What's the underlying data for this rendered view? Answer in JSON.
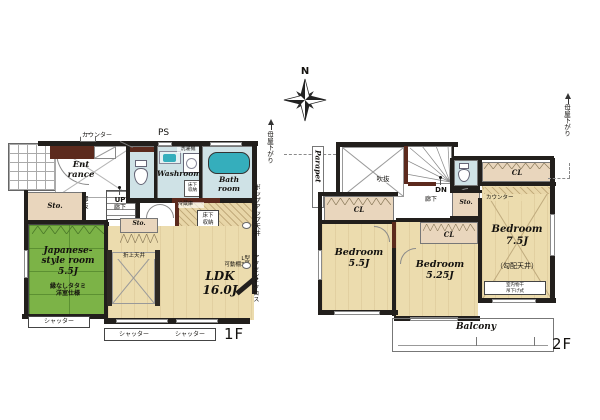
{
  "compass": {
    "north_label": "N"
  },
  "colors": {
    "wall": "#221f1c",
    "accent_wall": "#5c2a1d",
    "tatami_green": "#7cb347",
    "wood_floor": "#ecdcae",
    "wet_area": "#cfe2e6",
    "fixture_teal": "#35aebc",
    "sink_blue": "#2878b0",
    "storage_beige": "#e9d6bd"
  },
  "floor1": {
    "label": "1F",
    "rooms": {
      "entrance": "Ent\nrance",
      "storage1": "Sto.",
      "storage2": "Sto.",
      "japanese_room": "Japanese-\nstyle room\n5.5J",
      "japanese_room_note": "縁なしタタミ\n洋室仕様",
      "ldk": "LDK\n16.0J",
      "washroom": "Washroom",
      "bathroom": "Bath\nroom"
    },
    "labels": {
      "counter": "カウンター",
      "ps": "PS",
      "washing_machine": "洗濯機",
      "underfloor_storage": "床下\n収納",
      "upper_void": "上部\n吹抜",
      "up": "UP",
      "hallway": "廊下",
      "refrigerator": "冷蔵庫",
      "coffered_ceiling": "折上天井",
      "popup_ceiling": "ポップアップ天井",
      "l_shelf": "L型\n可動棚3段",
      "accent_cloth": "アクセントクロス",
      "shutter": "シャッター"
    }
  },
  "floor2": {
    "label": "2F",
    "rooms": {
      "bedroom1": "Bedroom\n5.5J",
      "bedroom2": "Bedroom\n5.25J",
      "bedroom3": "Bedroom\n7.5J",
      "bedroom3_note": "（勾配天井）",
      "balcony": "Balcony",
      "parapet": "Parapet",
      "closet": "CL",
      "storage": "Sto."
    },
    "labels": {
      "void": "吹抜",
      "down": "DN",
      "hallway": "廊下",
      "counter": "カウンター",
      "indoor_drying": "室内物干\n吊下げ式",
      "roof_lowered": "母屋下がり"
    }
  }
}
